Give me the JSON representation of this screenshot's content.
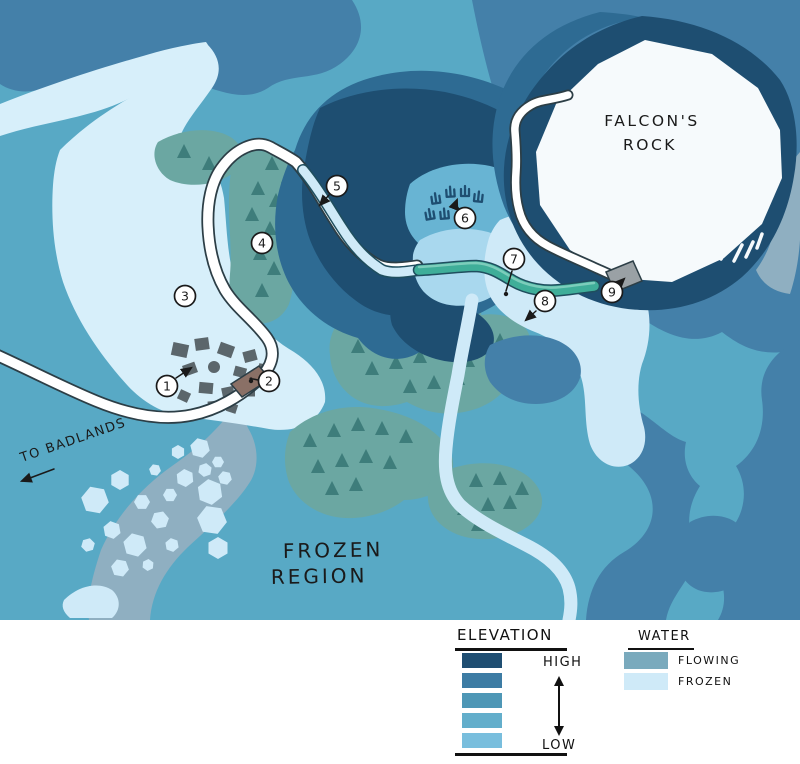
{
  "map": {
    "labels": {
      "falcons_rock_line1": "FALCON'S",
      "falcons_rock_line2": "ROCK",
      "region_line1": "FROZEN",
      "region_line2": "REGION",
      "to_badlands": "TO BADLANDS"
    },
    "markers": [
      {
        "label": "1"
      },
      {
        "label": "2"
      },
      {
        "label": "3"
      },
      {
        "label": "4"
      },
      {
        "label": "5"
      },
      {
        "label": "6"
      },
      {
        "label": "7"
      },
      {
        "label": "8"
      },
      {
        "label": "9"
      }
    ]
  },
  "legend": {
    "elevation": {
      "title": "ELEVATION",
      "high_label": "HIGH",
      "low_label": "LOW",
      "scale_colors": [
        "#1f4e72",
        "#3d7ca4",
        "#4e97b6",
        "#63aecb",
        "#79bedd"
      ]
    },
    "water": {
      "title": "WATER",
      "items": [
        {
          "label": "FLOWING",
          "color": "#7aaabd"
        },
        {
          "label": "FROZEN",
          "color": "#cfeaf8"
        }
      ]
    }
  },
  "palette": {
    "base": "#58a9c5",
    "elev2": "#4480a9",
    "ring": "#2e6b93",
    "high": "#1e4e71",
    "lightmed": "#68b4d3",
    "pond": "#a9d8ee",
    "frozen": "#cfeaf8",
    "frozenlake": "#d7effa",
    "flowing": "#8fafc1",
    "river_teal": "#3fae99",
    "river_teal_hi": "#7ccdbb",
    "river_outline": "#1f4e5e",
    "forest": "#6ba7a2",
    "tree": "#3e7d7b",
    "road": "#ffffff",
    "road_outline": "#2c3e46",
    "village": "#5b666b",
    "bridge_brown": "#8a7066",
    "bridge_gray": "#9aa1a5",
    "rock": "#f6fafc",
    "ink": "#1a1a1a"
  }
}
